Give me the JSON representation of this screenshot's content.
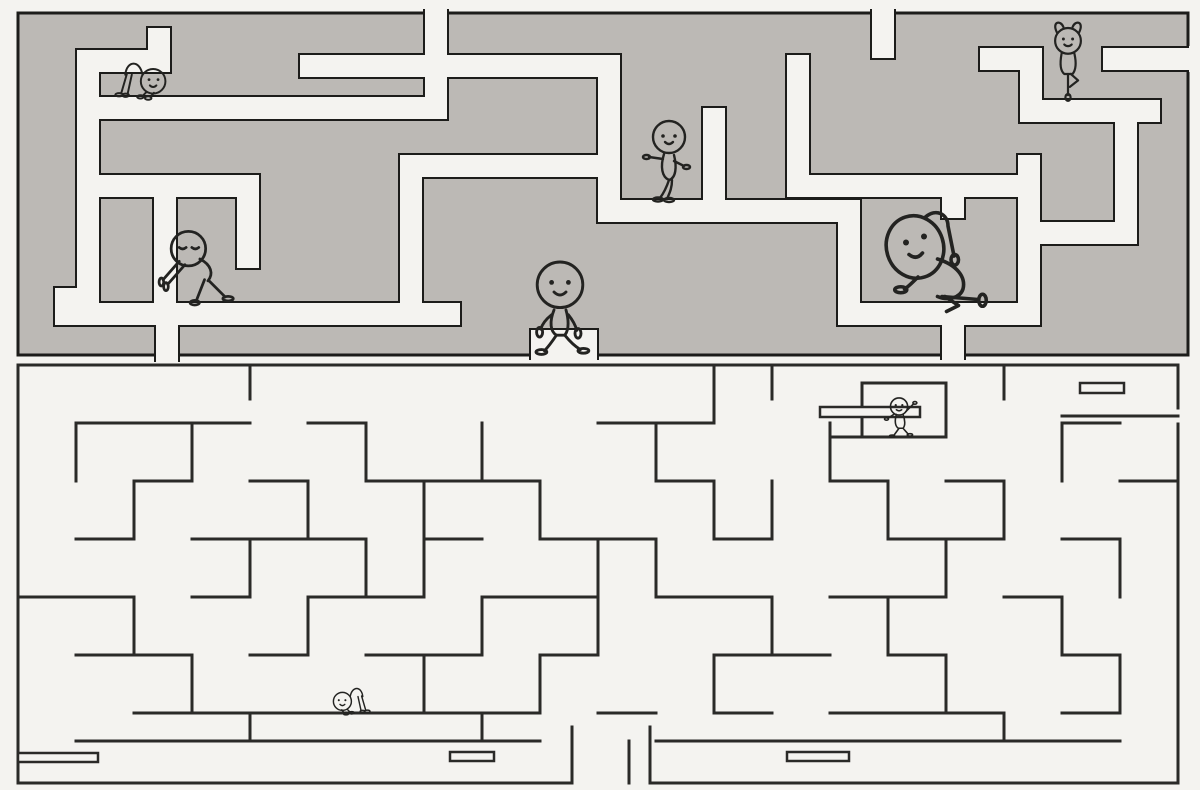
{
  "meta": {
    "title": "Two-part maze puzzle with smiling stick figures",
    "canvas": {
      "width": 1200,
      "height": 790
    }
  },
  "colors": {
    "background": "#f4f3f0",
    "top_maze_wall_fill": "#bcb9b5",
    "outline": "#1c1c1a",
    "bottom_maze_line": "#2a2a28",
    "character_ink": "#232321"
  },
  "top_maze": {
    "style": "thick gray wall blocks with black outlines, off-white corridors",
    "outer": [
      18,
      13,
      1170,
      342
    ],
    "corridor_width": 22,
    "corridors": [
      [
        425,
        11,
        22,
        108
      ],
      [
        872,
        11,
        22,
        47
      ],
      [
        77,
        97,
        370,
        22
      ],
      [
        77,
        50,
        22,
        69
      ],
      [
        77,
        50,
        93,
        22
      ],
      [
        148,
        28,
        22,
        44
      ],
      [
        77,
        97,
        22,
        213
      ],
      [
        55,
        288,
        22,
        37
      ],
      [
        55,
        303,
        405,
        22
      ],
      [
        77,
        175,
        182,
        22
      ],
      [
        237,
        197,
        22,
        71
      ],
      [
        154,
        197,
        22,
        128
      ],
      [
        300,
        55,
        320,
        22
      ],
      [
        598,
        77,
        22,
        145
      ],
      [
        400,
        155,
        220,
        22
      ],
      [
        400,
        177,
        22,
        148
      ],
      [
        598,
        200,
        262,
        22
      ],
      [
        703,
        108,
        22,
        92
      ],
      [
        806,
        175,
        234,
        22
      ],
      [
        787,
        55,
        22,
        142
      ],
      [
        838,
        200,
        22,
        125
      ],
      [
        838,
        303,
        202,
        22
      ],
      [
        942,
        180,
        22,
        38
      ],
      [
        1018,
        155,
        22,
        170
      ],
      [
        156,
        310,
        22,
        50
      ],
      [
        531,
        330,
        66,
        28
      ],
      [
        942,
        325,
        22,
        33
      ],
      [
        1040,
        100,
        120,
        22
      ],
      [
        1103,
        48,
        87,
        22
      ],
      [
        1115,
        122,
        22,
        122
      ],
      [
        1040,
        222,
        75,
        22
      ],
      [
        1020,
        48,
        22,
        74
      ],
      [
        980,
        48,
        62,
        22
      ]
    ],
    "opening_masks": [
      [
        425,
        7,
        22,
        7
      ],
      [
        872,
        7,
        22,
        7
      ],
      [
        1189,
        46,
        11,
        26
      ],
      [
        156,
        355,
        22,
        9
      ],
      [
        531,
        355,
        66,
        9
      ],
      [
        942,
        355,
        22,
        9
      ]
    ]
  },
  "bottom_maze": {
    "style": "thin black line walls on off-white background",
    "segments": [
      [
        18,
        365,
        1178,
        365
      ],
      [
        18,
        365,
        18,
        783
      ],
      [
        1178,
        365,
        1178,
        408
      ],
      [
        1178,
        424,
        1178,
        783
      ],
      [
        18,
        783,
        572,
        783
      ],
      [
        650,
        783,
        1178,
        783
      ],
      [
        572,
        727,
        572,
        783
      ],
      [
        650,
        727,
        650,
        783
      ],
      [
        629,
        741,
        629,
        783
      ],
      [
        250,
        365,
        250,
        399
      ],
      [
        714,
        365,
        714,
        423
      ],
      [
        772,
        365,
        772,
        399
      ],
      [
        1004,
        365,
        1004,
        399
      ],
      [
        1062,
        416,
        1178,
        416
      ],
      [
        862,
        383,
        946,
        383
      ],
      [
        862,
        383,
        862,
        437
      ],
      [
        830,
        437,
        946,
        437
      ],
      [
        946,
        383,
        946,
        437
      ],
      [
        76,
        423,
        250,
        423
      ],
      [
        308,
        423,
        366,
        423
      ],
      [
        598,
        423,
        714,
        423
      ],
      [
        1062,
        423,
        1120,
        423
      ],
      [
        134,
        481,
        192,
        481
      ],
      [
        250,
        481,
        308,
        481
      ],
      [
        366,
        481,
        540,
        481
      ],
      [
        656,
        481,
        714,
        481
      ],
      [
        830,
        481,
        888,
        481
      ],
      [
        946,
        481,
        1004,
        481
      ],
      [
        1120,
        481,
        1178,
        481
      ],
      [
        76,
        539,
        134,
        539
      ],
      [
        192,
        539,
        366,
        539
      ],
      [
        424,
        539,
        482,
        539
      ],
      [
        540,
        539,
        656,
        539
      ],
      [
        714,
        539,
        772,
        539
      ],
      [
        888,
        539,
        1004,
        539
      ],
      [
        1062,
        539,
        1120,
        539
      ],
      [
        18,
        597,
        134,
        597
      ],
      [
        192,
        597,
        250,
        597
      ],
      [
        308,
        597,
        424,
        597
      ],
      [
        482,
        597,
        598,
        597
      ],
      [
        656,
        597,
        772,
        597
      ],
      [
        830,
        597,
        946,
        597
      ],
      [
        1004,
        597,
        1062,
        597
      ],
      [
        76,
        655,
        192,
        655
      ],
      [
        250,
        655,
        308,
        655
      ],
      [
        366,
        655,
        482,
        655
      ],
      [
        540,
        655,
        598,
        655
      ],
      [
        714,
        655,
        830,
        655
      ],
      [
        888,
        655,
        946,
        655
      ],
      [
        1062,
        655,
        1120,
        655
      ],
      [
        134,
        713,
        540,
        713
      ],
      [
        598,
        713,
        656,
        713
      ],
      [
        714,
        713,
        772,
        713
      ],
      [
        830,
        713,
        1004,
        713
      ],
      [
        1062,
        713,
        1120,
        713
      ],
      [
        76,
        741,
        540,
        741
      ],
      [
        656,
        741,
        1120,
        741
      ],
      [
        76,
        423,
        76,
        481
      ],
      [
        192,
        423,
        192,
        481
      ],
      [
        366,
        423,
        366,
        481
      ],
      [
        482,
        423,
        482,
        481
      ],
      [
        656,
        423,
        656,
        481
      ],
      [
        830,
        423,
        830,
        481
      ],
      [
        1062,
        423,
        1062,
        481
      ],
      [
        134,
        481,
        134,
        539
      ],
      [
        308,
        481,
        308,
        539
      ],
      [
        424,
        481,
        424,
        597
      ],
      [
        540,
        481,
        540,
        539
      ],
      [
        714,
        481,
        714,
        539
      ],
      [
        772,
        481,
        772,
        539
      ],
      [
        888,
        481,
        888,
        539
      ],
      [
        1004,
        481,
        1004,
        539
      ],
      [
        250,
        539,
        250,
        597
      ],
      [
        366,
        539,
        366,
        597
      ],
      [
        598,
        539,
        598,
        597
      ],
      [
        656,
        539,
        656,
        597
      ],
      [
        946,
        539,
        946,
        597
      ],
      [
        1120,
        539,
        1120,
        597
      ],
      [
        134,
        597,
        134,
        655
      ],
      [
        308,
        597,
        308,
        655
      ],
      [
        482,
        597,
        482,
        655
      ],
      [
        598,
        597,
        598,
        655
      ],
      [
        772,
        597,
        772,
        655
      ],
      [
        888,
        597,
        888,
        655
      ],
      [
        1062,
        597,
        1062,
        655
      ],
      [
        192,
        655,
        192,
        713
      ],
      [
        424,
        655,
        424,
        713
      ],
      [
        540,
        655,
        540,
        713
      ],
      [
        714,
        655,
        714,
        713
      ],
      [
        946,
        655,
        946,
        713
      ],
      [
        1120,
        655,
        1120,
        713
      ],
      [
        250,
        713,
        250,
        741
      ],
      [
        482,
        713,
        482,
        741
      ],
      [
        1004,
        713,
        1004,
        741
      ]
    ],
    "bars": [
      [
        820,
        407,
        100,
        10
      ],
      [
        1080,
        383,
        44,
        10
      ],
      [
        18,
        753,
        80,
        9
      ],
      [
        450,
        752,
        44,
        9
      ],
      [
        787,
        752,
        62,
        9
      ]
    ]
  },
  "characters": [
    {
      "id": "crawler-top",
      "pose": "crawl",
      "expression": "smiling",
      "location": "top maze, upper left ledge",
      "x": 99,
      "y": 37,
      "scale": 0.82,
      "flip": false
    },
    {
      "id": "tree-pose",
      "pose": "tree",
      "expression": "smiling",
      "location": "top maze, upper right",
      "x": 1022,
      "y": 16,
      "scale": 0.92,
      "flip": false
    },
    {
      "id": "stander",
      "pose": "stand",
      "expression": "smiling",
      "location": "top maze, center",
      "x": 622,
      "y": 111,
      "scale": 1.0,
      "flip": false
    },
    {
      "id": "leaner",
      "pose": "lean",
      "expression": "eyes closed",
      "location": "top maze, left block",
      "x": 147,
      "y": 213,
      "scale": 1.15,
      "flip": false
    },
    {
      "id": "walker",
      "pose": "walk",
      "expression": "smiling",
      "location": "between the two mazes, center",
      "x": 500,
      "y": 250,
      "scale": 1.2,
      "flip": false
    },
    {
      "id": "stretcher",
      "pose": "stretch",
      "expression": "smiling",
      "location": "top maze, right side",
      "x": 855,
      "y": 193,
      "scale": 1.5,
      "flip": false
    },
    {
      "id": "waver",
      "pose": "wave",
      "expression": "smiling",
      "location": "bottom maze, upper right cell",
      "x": 870,
      "y": 388,
      "scale": 0.66,
      "flip": false
    },
    {
      "id": "crawler-bottom",
      "pose": "crawl",
      "expression": "smiling",
      "location": "bottom maze, lower left",
      "x": 322,
      "y": 669,
      "scale": 0.6,
      "flip": true
    }
  ]
}
